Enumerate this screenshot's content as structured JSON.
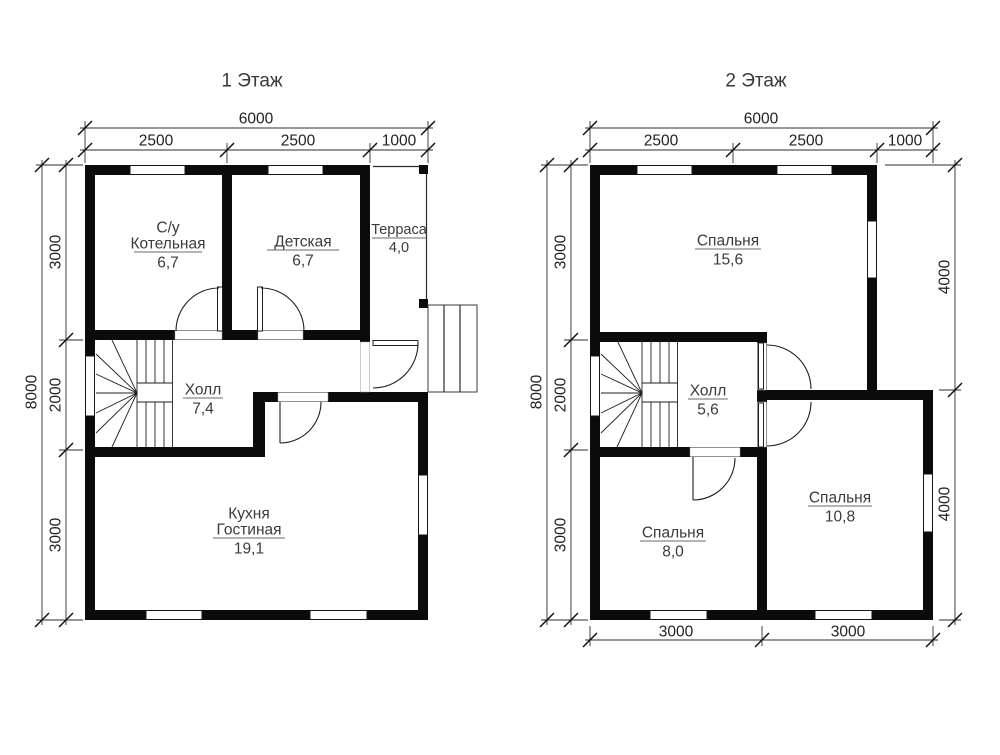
{
  "colors": {
    "wall": "#0b0b0b",
    "text": "#3b3b3b",
    "dimension": "#222222",
    "background": "#ffffff"
  },
  "floor1": {
    "title": "1 Этаж",
    "dims": {
      "width_total": "6000",
      "width_segments": [
        "2500",
        "2500",
        "1000"
      ],
      "height_total": "8000",
      "height_segments": [
        "3000",
        "2000",
        "3000"
      ]
    },
    "rooms": [
      {
        "id": "bathroom-boiler",
        "name_lines": [
          "С/у",
          "Котельная"
        ],
        "area": "6,7"
      },
      {
        "id": "kids-room",
        "name": "Детская",
        "area": "6,7"
      },
      {
        "id": "terrace",
        "name": "Терраса",
        "area": "4,0"
      },
      {
        "id": "hall",
        "name": "Холл",
        "area": "7,4"
      },
      {
        "id": "kitchen-living",
        "name_lines": [
          "Кухня",
          "Гостиная"
        ],
        "area": "19,1"
      }
    ]
  },
  "floor2": {
    "title": "2 Этаж",
    "dims": {
      "width_total": "6000",
      "width_segments": [
        "2500",
        "2500",
        "1000"
      ],
      "height_total": "8000",
      "height_segments": [
        "3000",
        "2000",
        "3000"
      ],
      "right_segments": [
        "4000",
        "4000"
      ],
      "bottom_segments": [
        "3000",
        "3000"
      ]
    },
    "rooms": [
      {
        "id": "bedroom-large",
        "name": "Спальня",
        "area": "15,6"
      },
      {
        "id": "hall",
        "name": "Холл",
        "area": "5,6"
      },
      {
        "id": "bedroom-small",
        "name": "Спальня",
        "area": "8,0"
      },
      {
        "id": "bedroom-mid",
        "name": "Спальня",
        "area": "10,8"
      }
    ]
  }
}
